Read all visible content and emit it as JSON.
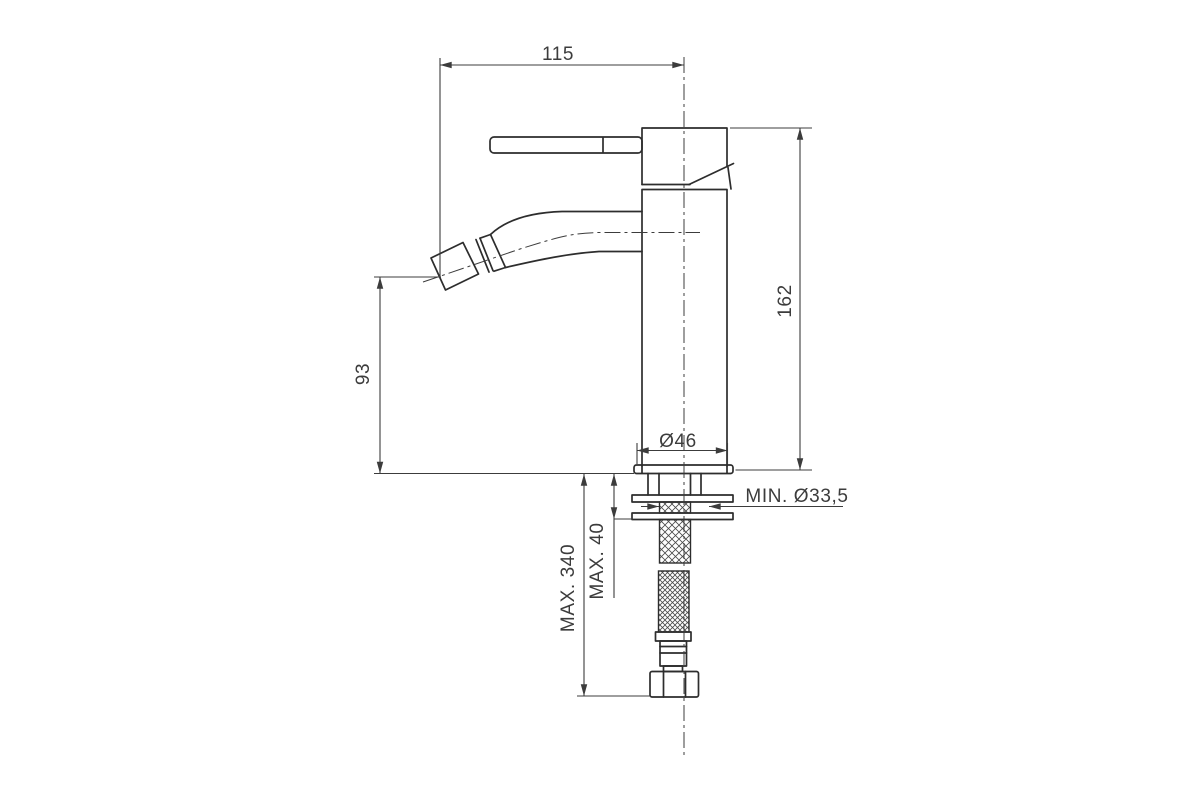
{
  "page": {
    "background": "#ffffff"
  },
  "drawing": {
    "type": "technical-dimension-drawing",
    "line_color": "#2d2d2d",
    "dimension_color": "#3c3c3c",
    "labels": {
      "spout_reach": "115",
      "overall_height": "162",
      "spout_height": "93",
      "body_diameter": "Ø46",
      "min_hole_diameter": "MIN. Ø33,5",
      "max_hose_length": "MAX. 340",
      "max_deck_thickness": "MAX. 40"
    }
  }
}
